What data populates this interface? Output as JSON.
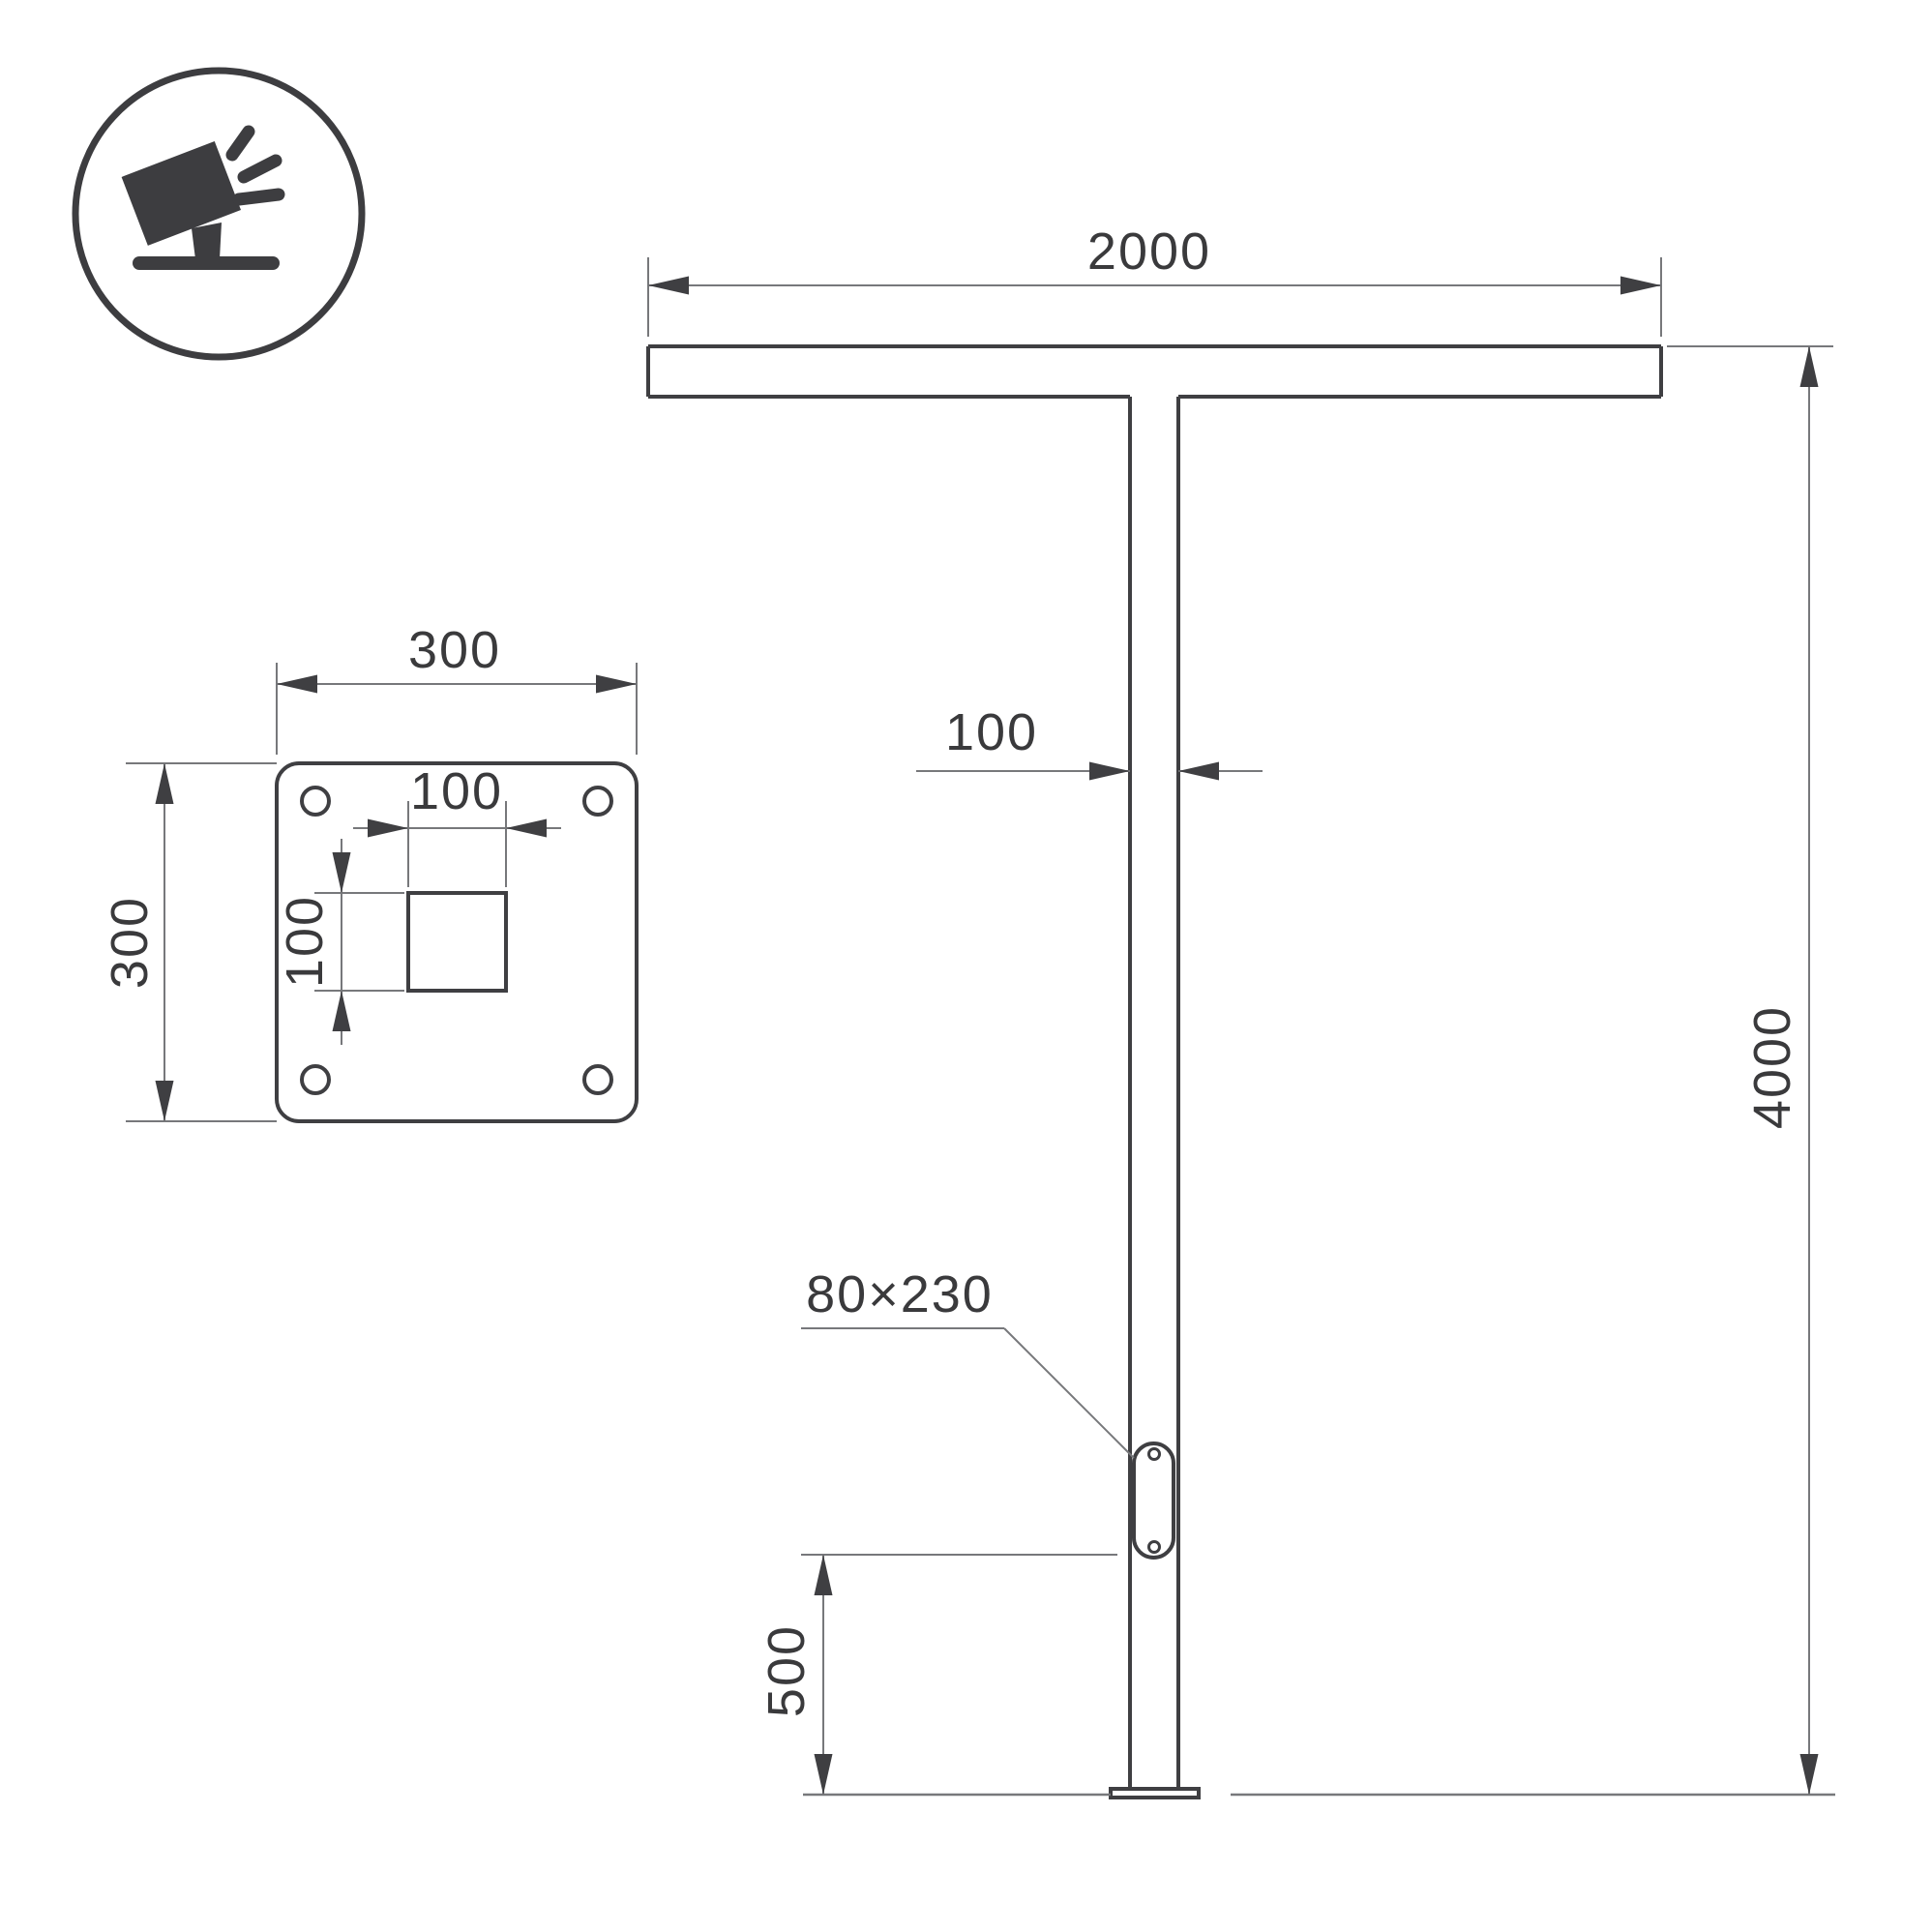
{
  "drawing": {
    "type": "technical-dimension-drawing",
    "subject": "street light pole with T-shaped luminaire arm, front view and base plate detail"
  },
  "colors": {
    "bg": "#ffffff",
    "line": "#3f3f42",
    "dim": "#77787b",
    "text": "#3a3a3c",
    "icon": "#3d3d40"
  },
  "icon": {
    "name": "floodlight-icon",
    "description": "tilted floodlight on a stand with light rays, inside a circle"
  },
  "pole_view": {
    "arm_length": "2000",
    "pole_width": "100",
    "hatch_size": "80×230",
    "hatch_bottom_height": "500",
    "pole_height": "4000"
  },
  "plate_view": {
    "plate_width": "300",
    "plate_height": "300",
    "cutout_width": "100",
    "cutout_height": "100"
  }
}
